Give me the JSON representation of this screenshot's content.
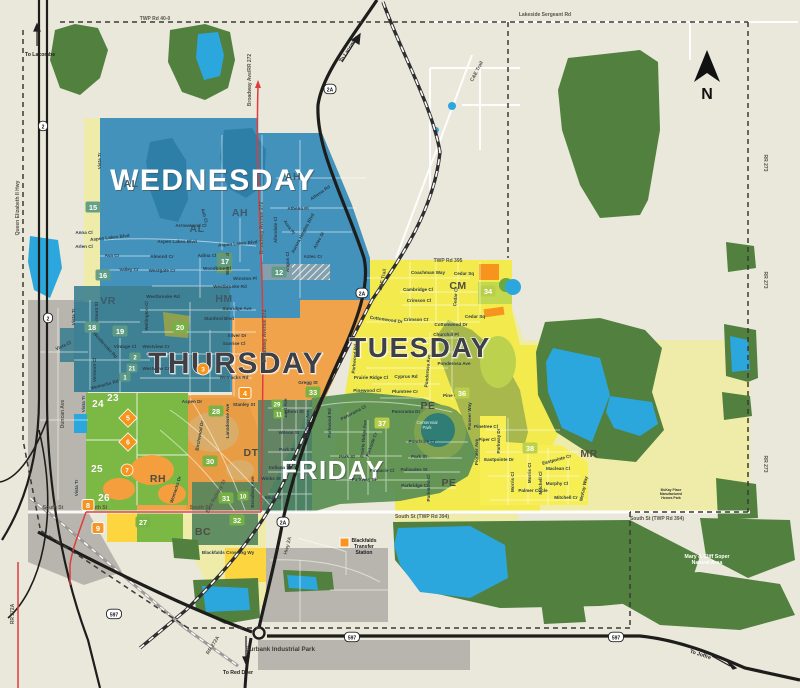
{
  "map": {
    "background": "#eae7db",
    "compass_label": "N",
    "colors": {
      "forest": "#51803f",
      "lake": "#2ba7de",
      "wednesday": "#4292bc",
      "vr_teal": "#3e7f90",
      "thursday": "#f1a34c",
      "rh_tan": "#e0993f",
      "tuesday": "#f3eb4d",
      "friday": "#5d9055",
      "dt_green": "#4a7f66",
      "pale_zone": "#efeca9",
      "green_zone": "#7cb944",
      "gray_zone": "#b7b5ad",
      "red_road": "#e03c3c",
      "highway": "#1d1d1b",
      "badge_teal": "#5f9b85",
      "badge_green": "#76b243",
      "badge_lime": "#b9cf49",
      "badge_orange": "#f7941d"
    },
    "day_labels": [
      {
        "t": "WEDNESDAY",
        "x": 213,
        "y": 190,
        "s": 30,
        "style": "light"
      },
      {
        "t": "THURSDAY",
        "x": 236,
        "y": 373,
        "s": 30,
        "style": "dark"
      },
      {
        "t": "TUESDAY",
        "x": 420,
        "y": 357,
        "s": 28,
        "style": "dark"
      },
      {
        "t": "FRIDAY",
        "x": 333,
        "y": 479,
        "s": 26,
        "style": "light"
      }
    ],
    "district_labels": [
      {
        "t": "AH",
        "x": 240,
        "y": 216
      },
      {
        "t": "AH",
        "x": 293,
        "y": 180
      },
      {
        "t": "AL",
        "x": 131,
        "y": 187
      },
      {
        "t": "AL",
        "x": 197,
        "y": 232
      },
      {
        "t": "VR",
        "x": 108,
        "y": 304
      },
      {
        "t": "HM",
        "x": 224,
        "y": 302
      },
      {
        "t": "CM",
        "x": 458,
        "y": 289,
        "cls": "d2"
      },
      {
        "t": "PE",
        "x": 428,
        "y": 409,
        "cls": "d2"
      },
      {
        "t": "PE",
        "x": 449,
        "y": 486,
        "cls": "d2"
      },
      {
        "t": "DT",
        "x": 251,
        "y": 456,
        "cls": "d2"
      },
      {
        "t": "RH",
        "x": 158,
        "y": 482,
        "cls": "d2"
      },
      {
        "t": "BC",
        "x": 203,
        "y": 535,
        "cls": "d2"
      },
      {
        "t": "MR",
        "x": 589,
        "y": 457,
        "cls": "d2"
      }
    ],
    "road_labels": [
      {
        "t": "TWP Rd 40-0",
        "x": 155,
        "y": 20
      },
      {
        "t": "Lakeside Sergeant Rd",
        "x": 545,
        "y": 16
      },
      {
        "t": "TWP Rd 395",
        "x": 448,
        "y": 262
      },
      {
        "t": "C&E Trail",
        "x": 478,
        "y": 72,
        "r": -62
      },
      {
        "t": "C&E Trail",
        "x": 384,
        "y": 280,
        "r": -78
      },
      {
        "t": "RR 273",
        "x": 764,
        "y": 163,
        "r": 90
      },
      {
        "t": "RR 273",
        "x": 764,
        "y": 280,
        "r": 90
      },
      {
        "t": "RR 273",
        "x": 764,
        "y": 464,
        "r": 90
      },
      {
        "t": "Queen Elizabeth II Hwy",
        "x": 19,
        "y": 208,
        "r": -90
      },
      {
        "t": "Broadway Ave/RR 272",
        "x": 251,
        "y": 80,
        "r": -90
      },
      {
        "t": "Broadway Avenue 272",
        "x": 263,
        "y": 228,
        "r": -90
      },
      {
        "t": "Broadway Avenue 272",
        "x": 266,
        "y": 336,
        "r": -90
      },
      {
        "t": "Hwy 2A",
        "x": 289,
        "y": 546,
        "r": -75
      },
      {
        "t": "RR 272A",
        "x": 214,
        "y": 646,
        "r": -58
      },
      {
        "t": "RR 272A",
        "x": 14,
        "y": 614,
        "r": -90
      },
      {
        "t": "South St",
        "x": 53,
        "y": 509
      },
      {
        "t": "South St",
        "x": 97,
        "y": 509
      },
      {
        "t": "South St",
        "x": 200,
        "y": 509
      },
      {
        "t": "South St (TWP Rd 394)",
        "x": 422,
        "y": 518
      },
      {
        "t": "South St (TWP Rd 394)",
        "x": 657,
        "y": 520
      },
      {
        "t": "Duncan Ave",
        "x": 64,
        "y": 414,
        "r": -90
      },
      {
        "t": "East Railway St",
        "x": 217,
        "y": 497,
        "r": -62
      }
    ],
    "direction_labels": [
      {
        "t": "To Lacombe",
        "x": 40,
        "y": 56
      },
      {
        "t": "To Lacombe",
        "x": 350,
        "y": 50,
        "r": -57
      },
      {
        "t": "To Red Deer",
        "x": 238,
        "y": 674
      },
      {
        "t": "To Joffre",
        "x": 700,
        "y": 656,
        "r": 18
      }
    ],
    "street_labels": [
      {
        "t": "Vista Tr",
        "x": 101,
        "y": 161,
        "r": -90
      },
      {
        "t": "Anna Cl",
        "x": 84,
        "y": 234
      },
      {
        "t": "Arlen Cl",
        "x": 84,
        "y": 248
      },
      {
        "t": "Ava Cr",
        "x": 112,
        "y": 257
      },
      {
        "t": "Valley Cr",
        "x": 129,
        "y": 271
      },
      {
        "t": "Westgate Cr",
        "x": 162,
        "y": 272
      },
      {
        "t": "Almond Cr",
        "x": 162,
        "y": 258
      },
      {
        "t": "Adina Cl",
        "x": 207,
        "y": 257
      },
      {
        "t": "Woodbine Cl",
        "x": 217,
        "y": 270
      },
      {
        "t": "Aspen Lakes Blvd",
        "x": 110,
        "y": 239,
        "r": -6
      },
      {
        "t": "Aspen Lakes Blvd",
        "x": 177,
        "y": 243
      },
      {
        "t": "Aspen Lakes Blvd",
        "x": 238,
        "y": 245,
        "r": -5
      },
      {
        "t": "Arrowwood Cl",
        "x": 191,
        "y": 227
      },
      {
        "t": "Ash Cl",
        "x": 203,
        "y": 216,
        "r": 75
      },
      {
        "t": "Athena Pl",
        "x": 298,
        "y": 210
      },
      {
        "t": "Athena Rd",
        "x": 321,
        "y": 194,
        "r": -35
      },
      {
        "t": "Aura Pl",
        "x": 288,
        "y": 228,
        "r": 55
      },
      {
        "t": "Aurora Heights Blvd",
        "x": 304,
        "y": 234,
        "r": -62
      },
      {
        "t": "Aztec St",
        "x": 320,
        "y": 241,
        "r": -62
      },
      {
        "t": "Aztec Cr",
        "x": 313,
        "y": 258
      },
      {
        "t": "Allendale Cl",
        "x": 277,
        "y": 230,
        "r": -90
      },
      {
        "t": "Angus Cl",
        "x": 289,
        "y": 262,
        "r": -90
      },
      {
        "t": "Willow Rd",
        "x": 229,
        "y": 264,
        "r": -90
      },
      {
        "t": "Winston Pl",
        "x": 245,
        "y": 280
      },
      {
        "t": "Westbrooke Rd",
        "x": 230,
        "y": 288
      },
      {
        "t": "Westbrooke Rd",
        "x": 163,
        "y": 298
      },
      {
        "t": "Westbrooke Rd",
        "x": 104,
        "y": 346,
        "r": 48
      },
      {
        "t": "Vermont St",
        "x": 98,
        "y": 314,
        "r": -90
      },
      {
        "t": "Vista Tr",
        "x": 75,
        "y": 317,
        "r": -90
      },
      {
        "t": "Vintage Cl",
        "x": 125,
        "y": 348
      },
      {
        "t": "Vermont Cl",
        "x": 96,
        "y": 370,
        "r": -90
      },
      {
        "t": "Womacks Rd",
        "x": 105,
        "y": 386,
        "r": -15
      },
      {
        "t": "Womacks Rd",
        "x": 234,
        "y": 379
      },
      {
        "t": "Wellington Cl",
        "x": 148,
        "y": 316,
        "r": -90
      },
      {
        "t": "Sunridge Ave",
        "x": 237,
        "y": 310
      },
      {
        "t": "Stanford Blvd",
        "x": 219,
        "y": 320
      },
      {
        "t": "Silver Dr",
        "x": 237,
        "y": 337
      },
      {
        "t": "Sunrise Cl",
        "x": 234,
        "y": 345
      },
      {
        "t": "Westview Cr",
        "x": 156,
        "y": 348
      },
      {
        "t": "Westview Cr",
        "x": 156,
        "y": 370
      },
      {
        "t": "Gregg St",
        "x": 308,
        "y": 384
      },
      {
        "t": "Aspen Dr",
        "x": 192,
        "y": 403
      },
      {
        "t": "Stanley St",
        "x": 244,
        "y": 406
      },
      {
        "t": "Lansdowne Ave",
        "x": 229,
        "y": 421,
        "r": -90
      },
      {
        "t": "Birchwood Dr",
        "x": 201,
        "y": 436,
        "r": -80
      },
      {
        "t": "Womacks Dr",
        "x": 177,
        "y": 490,
        "r": -72
      },
      {
        "t": "East Ave",
        "x": 287,
        "y": 408,
        "r": -90
      },
      {
        "t": "Waghorn St",
        "x": 291,
        "y": 413
      },
      {
        "t": "Wilson St",
        "x": 289,
        "y": 434
      },
      {
        "t": "Park St",
        "x": 287,
        "y": 451
      },
      {
        "t": "Indiana St",
        "x": 280,
        "y": 469
      },
      {
        "t": "Winks St",
        "x": 271,
        "y": 480
      },
      {
        "t": "Shull St",
        "x": 273,
        "y": 499
      },
      {
        "t": "Highway Ave",
        "x": 309,
        "y": 424,
        "r": -90
      },
      {
        "t": "Broadway Ave",
        "x": 254,
        "y": 492,
        "r": -90
      },
      {
        "t": "Parkwood Rd",
        "x": 331,
        "y": 423,
        "r": -90
      },
      {
        "t": "Panorama Cl",
        "x": 354,
        "y": 414,
        "r": -28
      },
      {
        "t": "Panorama Dr",
        "x": 406,
        "y": 413
      },
      {
        "t": "Prairie Ridge Ave",
        "x": 365,
        "y": 439,
        "r": -85
      },
      {
        "t": "Parkside Cr",
        "x": 373,
        "y": 445,
        "r": -70
      },
      {
        "t": "Park St",
        "x": 347,
        "y": 458
      },
      {
        "t": "Pinnacle Cl",
        "x": 382,
        "y": 472
      },
      {
        "t": "Parkway Cl",
        "x": 364,
        "y": 481
      },
      {
        "t": "Pondside Cr",
        "x": 422,
        "y": 443
      },
      {
        "t": "Park St",
        "x": 419,
        "y": 458
      },
      {
        "t": "Palisades St",
        "x": 414,
        "y": 471
      },
      {
        "t": "Parkridge Cr",
        "x": 415,
        "y": 487
      },
      {
        "t": "Parkmont Cl",
        "x": 430,
        "y": 488,
        "r": -90
      },
      {
        "t": "Coachman Way",
        "x": 428,
        "y": 274
      },
      {
        "t": "Cedar Sq",
        "x": 464,
        "y": 275
      },
      {
        "t": "Cedar Sq",
        "x": 475,
        "y": 318
      },
      {
        "t": "Cedar Cl",
        "x": 457,
        "y": 297,
        "r": -85
      },
      {
        "t": "Cambridge Cl",
        "x": 418,
        "y": 291
      },
      {
        "t": "Crimson Cl",
        "x": 419,
        "y": 302
      },
      {
        "t": "Crimson Ct",
        "x": 416,
        "y": 321
      },
      {
        "t": "Cottonwood Dr",
        "x": 386,
        "y": 321,
        "r": 8
      },
      {
        "t": "Cottonwood Dr",
        "x": 451,
        "y": 326
      },
      {
        "t": "Churchill Pl",
        "x": 446,
        "y": 336
      },
      {
        "t": "Parkwood Rd",
        "x": 356,
        "y": 359,
        "r": -85
      },
      {
        "t": "Ponderosa Ave",
        "x": 454,
        "y": 365
      },
      {
        "t": "Ponderosa Ave",
        "x": 429,
        "y": 371,
        "r": -85
      },
      {
        "t": "Cyprus Rd",
        "x": 406,
        "y": 378
      },
      {
        "t": "Prairie Ridge Cl",
        "x": 371,
        "y": 379
      },
      {
        "t": "Pinewood Cl",
        "x": 367,
        "y": 392
      },
      {
        "t": "Plumtree Cr",
        "x": 405,
        "y": 393
      },
      {
        "t": "Pine Cr",
        "x": 451,
        "y": 397
      },
      {
        "t": "Pinetree Cl",
        "x": 486,
        "y": 428
      },
      {
        "t": "Piper Cl",
        "x": 487,
        "y": 441
      },
      {
        "t": "Parkway Dr",
        "x": 500,
        "y": 441,
        "r": -90
      },
      {
        "t": "Pioneer Ave",
        "x": 478,
        "y": 452,
        "r": -90
      },
      {
        "t": "Pioneer Way",
        "x": 471,
        "y": 416,
        "r": -90
      },
      {
        "t": "Eastpointe Dr",
        "x": 499,
        "y": 461
      },
      {
        "t": "Eastpointe Cr",
        "x": 557,
        "y": 461,
        "r": -15
      },
      {
        "t": "Maclean Cl",
        "x": 558,
        "y": 470
      },
      {
        "t": "Murphy Cl",
        "x": 557,
        "y": 485
      },
      {
        "t": "Mitchell Cr",
        "x": 566,
        "y": 499
      },
      {
        "t": "Mitchell Cl",
        "x": 542,
        "y": 483,
        "r": -90
      },
      {
        "t": "Morris Cl",
        "x": 514,
        "y": 482,
        "r": -90
      },
      {
        "t": "Morris Ct",
        "x": 531,
        "y": 473,
        "r": -90
      },
      {
        "t": "McKay Way",
        "x": 585,
        "y": 489,
        "r": -78
      },
      {
        "t": "Palmer Circle",
        "x": 533,
        "y": 492
      },
      {
        "t": "Blackfalds Crossing Wy",
        "x": 228,
        "y": 554
      },
      {
        "t": "Vista Tr",
        "x": 85,
        "y": 404,
        "r": -90
      },
      {
        "t": "Vista Tr",
        "x": 78,
        "y": 488,
        "r": -90
      },
      {
        "t": "Vista Cl",
        "x": 64,
        "y": 347,
        "r": -25
      }
    ],
    "poi_labels": [
      {
        "lines": [
          "Blackfalds",
          "Transfer",
          "Station"
        ],
        "x": 364,
        "y": 542,
        "cls": "poi-dark",
        "lh": 6
      },
      {
        "lines": [
          "Burbank Industrial Park"
        ],
        "x": 280,
        "y": 651,
        "cls": "poi-bold",
        "lh": 7
      },
      {
        "lines": [
          "Mary & Cliff Soper",
          "Natural Area"
        ],
        "x": 707,
        "y": 558,
        "cls": "poi-white",
        "lh": 6
      },
      {
        "lines": [
          "Centennial",
          "Park"
        ],
        "x": 427,
        "y": 424,
        "cls": "poi-white-small",
        "lh": 5
      },
      {
        "lines": [
          "McKay Place",
          "Manufactured",
          "Homes Park"
        ],
        "x": 671,
        "y": 491,
        "cls": "poi-tiny",
        "lh": 4
      }
    ],
    "badges": [
      {
        "n": "12",
        "x": 279,
        "y": 272,
        "t": "box",
        "c": "teal"
      },
      {
        "n": "15",
        "x": 93,
        "y": 207,
        "t": "box",
        "c": "teal"
      },
      {
        "n": "16",
        "x": 103,
        "y": 275,
        "t": "box",
        "c": "teal"
      },
      {
        "n": "17",
        "x": 225,
        "y": 261,
        "t": "box",
        "c": "teal"
      },
      {
        "n": "18",
        "x": 92,
        "y": 327,
        "t": "box",
        "c": "teal"
      },
      {
        "n": "19",
        "x": 120,
        "y": 331,
        "t": "box",
        "c": "teal"
      },
      {
        "n": "1",
        "x": 125,
        "y": 377,
        "t": "sm",
        "c": "teal"
      },
      {
        "n": "2",
        "x": 135,
        "y": 357,
        "t": "sm",
        "c": "teal"
      },
      {
        "n": "21",
        "x": 132,
        "y": 368,
        "t": "sm",
        "c": "teal"
      },
      {
        "n": "20",
        "x": 180,
        "y": 327,
        "t": "box",
        "c": "green"
      },
      {
        "n": "27",
        "x": 143,
        "y": 522,
        "t": "box",
        "c": "green"
      },
      {
        "n": "28",
        "x": 216,
        "y": 411,
        "t": "box",
        "c": "green"
      },
      {
        "n": "29",
        "x": 277,
        "y": 404,
        "t": "sm",
        "c": "green"
      },
      {
        "n": "11",
        "x": 279,
        "y": 414,
        "t": "sm",
        "c": "green"
      },
      {
        "n": "30",
        "x": 210,
        "y": 461,
        "t": "box",
        "c": "green"
      },
      {
        "n": "31",
        "x": 226,
        "y": 498,
        "t": "box",
        "c": "green"
      },
      {
        "n": "10",
        "x": 243,
        "y": 496,
        "t": "sm",
        "c": "green"
      },
      {
        "n": "32",
        "x": 237,
        "y": 520,
        "t": "box",
        "c": "green"
      },
      {
        "n": "33",
        "x": 313,
        "y": 392,
        "t": "box",
        "c": "green"
      },
      {
        "n": "34",
        "x": 488,
        "y": 291,
        "t": "box",
        "c": "lime"
      },
      {
        "n": "36",
        "x": 462,
        "y": 393,
        "t": "box",
        "c": "lime"
      },
      {
        "n": "37",
        "x": 382,
        "y": 423,
        "t": "box",
        "c": "lime"
      },
      {
        "n": "38",
        "x": 530,
        "y": 448,
        "t": "box",
        "c": "lime"
      },
      {
        "n": "4",
        "x": 245,
        "y": 393,
        "t": "box",
        "c": "orange"
      },
      {
        "n": "8",
        "x": 88,
        "y": 505,
        "t": "box",
        "c": "orange"
      },
      {
        "n": "9",
        "x": 98,
        "y": 528,
        "t": "box",
        "c": "orange"
      },
      {
        "n": "3",
        "x": 203,
        "y": 369,
        "t": "circle",
        "c": "orange"
      },
      {
        "n": "7",
        "x": 127,
        "y": 470,
        "t": "circle",
        "c": "orange"
      },
      {
        "n": "5",
        "x": 128,
        "y": 418,
        "t": "diamond",
        "c": "orange"
      },
      {
        "n": "6",
        "x": 128,
        "y": 442,
        "t": "diamond",
        "c": "orange"
      },
      {
        "n": "23",
        "x": 113,
        "y": 401,
        "t": "text"
      },
      {
        "n": "24",
        "x": 98,
        "y": 407,
        "t": "text"
      },
      {
        "n": "25",
        "x": 97,
        "y": 472,
        "t": "text"
      },
      {
        "n": "26",
        "x": 104,
        "y": 501,
        "t": "text"
      }
    ],
    "shields": [
      {
        "t": "2A",
        "x": 330,
        "y": 89
      },
      {
        "t": "2A",
        "x": 362,
        "y": 293
      },
      {
        "t": "2A",
        "x": 283,
        "y": 522
      },
      {
        "t": "597",
        "x": 114,
        "y": 614
      },
      {
        "t": "597",
        "x": 352,
        "y": 637
      },
      {
        "t": "597",
        "x": 616,
        "y": 637
      },
      {
        "t": "2",
        "x": 43,
        "y": 126
      },
      {
        "t": "2",
        "x": 48,
        "y": 318
      }
    ]
  }
}
